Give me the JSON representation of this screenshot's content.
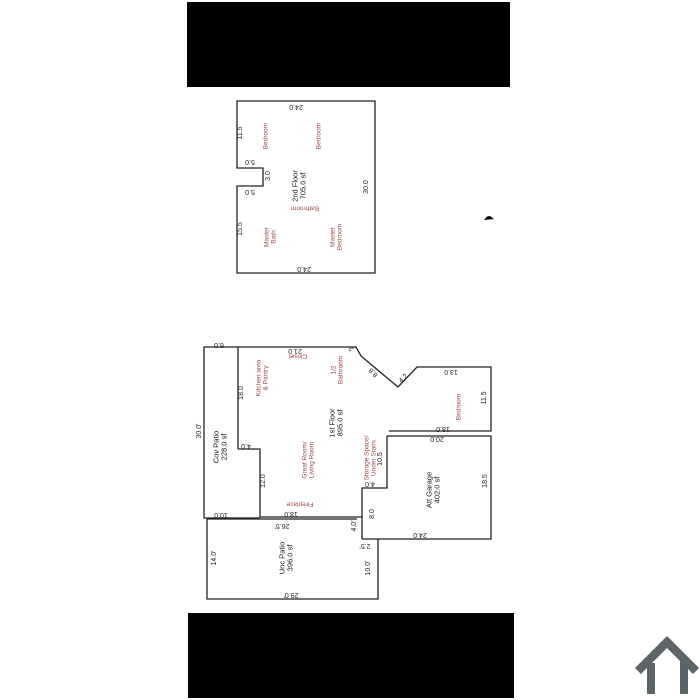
{
  "page": {
    "background": "#ffffff",
    "kind": "real-estate floor plan viewer"
  },
  "colors": {
    "wall": "#222222",
    "dim_text": "#1c1c1c",
    "room_text": "#9d4b4b",
    "letterbox": "#000000",
    "house_icon": "#5c6468"
  },
  "floorplans": {
    "second_floor": {
      "title": "2nd Floor",
      "area": "705.0 sf",
      "rooms": [
        "Bedroom",
        "Bedroom",
        "Bathroom",
        "Master Bath",
        "Master Bedroom"
      ],
      "dimensions": [
        "24.0",
        "11.5",
        "5.0",
        "3.0",
        "5.0",
        "15.5",
        "24.0",
        "30.0"
      ]
    },
    "first_floor": {
      "title": "1st Floor",
      "area": "895.0 sf",
      "rooms": [
        "Kitchen area & Pantry",
        "Closet",
        "1/2 Bathroom",
        "Bedroom",
        "Great Room/ Living Room",
        "Fireplace",
        "Storage Space/ Under Stairs"
      ],
      "zones": [
        {
          "title": "Cov Patio",
          "area": "228.0 sf"
        },
        {
          "title": "Unc Patio",
          "area": "396.0 sf"
        },
        {
          "title": "Att Garage",
          "area": "402.0 sf"
        }
      ],
      "dimensions": [
        "6.0",
        "21.0",
        "2",
        "8.8",
        "4.2",
        "13.0",
        "11.5",
        "18.0",
        "20.0",
        "18.0",
        "4.0",
        "12.0",
        "10.0",
        "18.0",
        "26.5'",
        "30.0'",
        "14.0'",
        "29.0'",
        "10.0'",
        "2.5'",
        "4.0'",
        "4.0",
        "8.0",
        "10.5",
        "24.0",
        "18.5"
      ]
    }
  },
  "labels": [
    {
      "n": "dim-label",
      "c": "dim",
      "t": "24.0",
      "x": 296,
      "y": 106,
      "r": 180
    },
    {
      "n": "dim-label",
      "c": "dim",
      "t": "11.5",
      "x": 241,
      "y": 133,
      "r": -90
    },
    {
      "n": "dim-label",
      "c": "dim",
      "t": "5.0",
      "x": 250,
      "y": 161,
      "r": 180
    },
    {
      "n": "dim-label",
      "c": "dim",
      "t": "3.0",
      "x": 269,
      "y": 176,
      "r": -90
    },
    {
      "n": "dim-label",
      "c": "dim",
      "t": "5.0",
      "x": 250,
      "y": 191,
      "r": 180
    },
    {
      "n": "dim-label",
      "c": "dim",
      "t": "15.5",
      "x": 241,
      "y": 229,
      "r": -90
    },
    {
      "n": "dim-label",
      "c": "dim",
      "t": "24.0",
      "x": 304,
      "y": 268,
      "r": 180
    },
    {
      "n": "dim-label",
      "c": "dim",
      "t": "30.0",
      "x": 367,
      "y": 187,
      "r": -90
    },
    {
      "n": "room-label",
      "c": "room",
      "t": "Bedroom",
      "x": 266,
      "y": 136,
      "r": -90
    },
    {
      "n": "room-label",
      "c": "room",
      "t": "Bedroom",
      "x": 319,
      "y": 136,
      "r": -90
    },
    {
      "n": "floor-title",
      "c": "title",
      "t": "2nd Floor\n705.0 sf",
      "x": 300,
      "y": 186,
      "r": -90
    },
    {
      "n": "room-label",
      "c": "room",
      "t": "Bathroom",
      "x": 305,
      "y": 208,
      "r": 180
    },
    {
      "n": "room-label",
      "c": "room",
      "t": "Master\nBath",
      "x": 271,
      "y": 237,
      "r": -90
    },
    {
      "n": "room-label",
      "c": "room",
      "t": "Master\nBedroom",
      "x": 337,
      "y": 237,
      "r": -90
    },
    {
      "n": "dim-label",
      "c": "dim",
      "t": "6.0",
      "x": 219,
      "y": 344,
      "r": 180
    },
    {
      "n": "dim-label",
      "c": "dim",
      "t": "21.0",
      "x": 295,
      "y": 350,
      "r": 180
    },
    {
      "n": "dim-label",
      "c": "dim",
      "t": "2",
      "x": 352,
      "y": 348,
      "r": -135
    },
    {
      "n": "dim-label",
      "c": "dim",
      "t": "8.8",
      "x": 374,
      "y": 372,
      "r": -135
    },
    {
      "n": "dim-label",
      "c": "dim",
      "t": "4.2",
      "x": 404,
      "y": 379,
      "r": -45
    },
    {
      "n": "dim-label",
      "c": "dim",
      "t": "13.0",
      "x": 451,
      "y": 371,
      "r": 180
    },
    {
      "n": "dim-label",
      "c": "dim",
      "t": "11.5",
      "x": 485,
      "y": 398,
      "r": -90
    },
    {
      "n": "dim-label",
      "c": "dim",
      "t": "18.0",
      "x": 443,
      "y": 428,
      "r": 180
    },
    {
      "n": "dim-label",
      "c": "dim",
      "t": "20.0",
      "x": 437,
      "y": 438,
      "r": 180
    },
    {
      "n": "dim-label",
      "c": "dim",
      "t": "18.0",
      "x": 242,
      "y": 393,
      "r": -90
    },
    {
      "n": "dim-label",
      "c": "dim",
      "t": "4.0",
      "x": 246,
      "y": 445,
      "r": 180
    },
    {
      "n": "dim-label",
      "c": "dim",
      "t": "12.0",
      "x": 264,
      "y": 481,
      "r": -90
    },
    {
      "n": "dim-label",
      "c": "dim",
      "t": "10.0",
      "x": 221,
      "y": 514,
      "r": 180
    },
    {
      "n": "dim-label",
      "c": "dim",
      "t": "18.0",
      "x": 291,
      "y": 513,
      "r": 180
    },
    {
      "n": "dim-label",
      "c": "dim",
      "t": "26.5'",
      "x": 282,
      "y": 525,
      "r": 180
    },
    {
      "n": "dim-label",
      "c": "dim",
      "t": "30.0'",
      "x": 200,
      "y": 431,
      "r": -90
    },
    {
      "n": "dim-label",
      "c": "dim",
      "t": "14.0'",
      "x": 215,
      "y": 558,
      "r": -90
    },
    {
      "n": "dim-label",
      "c": "dim",
      "t": "29.0'",
      "x": 291,
      "y": 594,
      "r": 180
    },
    {
      "n": "dim-label",
      "c": "dim",
      "t": "10.0'",
      "x": 369,
      "y": 568,
      "r": -90
    },
    {
      "n": "dim-label",
      "c": "dim",
      "t": "2.5'",
      "x": 365,
      "y": 545,
      "r": 180
    },
    {
      "n": "dim-label",
      "c": "dim",
      "t": "4.0'",
      "x": 355,
      "y": 526,
      "r": -90
    },
    {
      "n": "dim-label",
      "c": "dim",
      "t": "4.0",
      "x": 370,
      "y": 483,
      "r": 180
    },
    {
      "n": "dim-label",
      "c": "dim",
      "t": "8.0",
      "x": 373,
      "y": 514,
      "r": -90
    },
    {
      "n": "dim-label",
      "c": "dim",
      "t": "10.5",
      "x": 381,
      "y": 459,
      "r": -90
    },
    {
      "n": "dim-label",
      "c": "dim",
      "t": "24.0",
      "x": 420,
      "y": 534,
      "r": 180
    },
    {
      "n": "dim-label",
      "c": "dim",
      "t": "18.5",
      "x": 486,
      "y": 481,
      "r": -90
    },
    {
      "n": "room-label",
      "c": "room",
      "t": "Kitchen area\n& Pantry",
      "x": 263,
      "y": 378,
      "r": -90
    },
    {
      "n": "room-label",
      "c": "room",
      "t": "Closet",
      "x": 298,
      "y": 356,
      "r": 180
    },
    {
      "n": "room-label",
      "c": "room",
      "t": "1/2\nBathroom",
      "x": 338,
      "y": 370,
      "r": -90
    },
    {
      "n": "room-label",
      "c": "room",
      "t": "Bedroom",
      "x": 459,
      "y": 407,
      "r": -90
    },
    {
      "n": "room-label",
      "c": "room",
      "t": "Great Room/\nLiving Room",
      "x": 309,
      "y": 460,
      "r": -90
    },
    {
      "n": "room-label",
      "c": "room",
      "t": "Fireplace",
      "x": 300,
      "y": 504,
      "r": 180
    },
    {
      "n": "room-label",
      "c": "room",
      "t": "Storage Space/\nUnder Stairs",
      "x": 371,
      "y": 458,
      "r": -90
    },
    {
      "n": "floor-title",
      "c": "title",
      "t": "1st Floor\n895.0 sf",
      "x": 337,
      "y": 423,
      "r": -90
    },
    {
      "n": "floor-title",
      "c": "title",
      "t": "Cov Patio\n228.0 sf",
      "x": 221,
      "y": 447,
      "r": -90
    },
    {
      "n": "floor-title",
      "c": "title",
      "t": "Unc Patio\n396.0 sf",
      "x": 287,
      "y": 558,
      "r": -90
    },
    {
      "n": "floor-title",
      "c": "title",
      "t": "Att Garage\n402.0 sf",
      "x": 434,
      "y": 490,
      "r": -90
    }
  ]
}
